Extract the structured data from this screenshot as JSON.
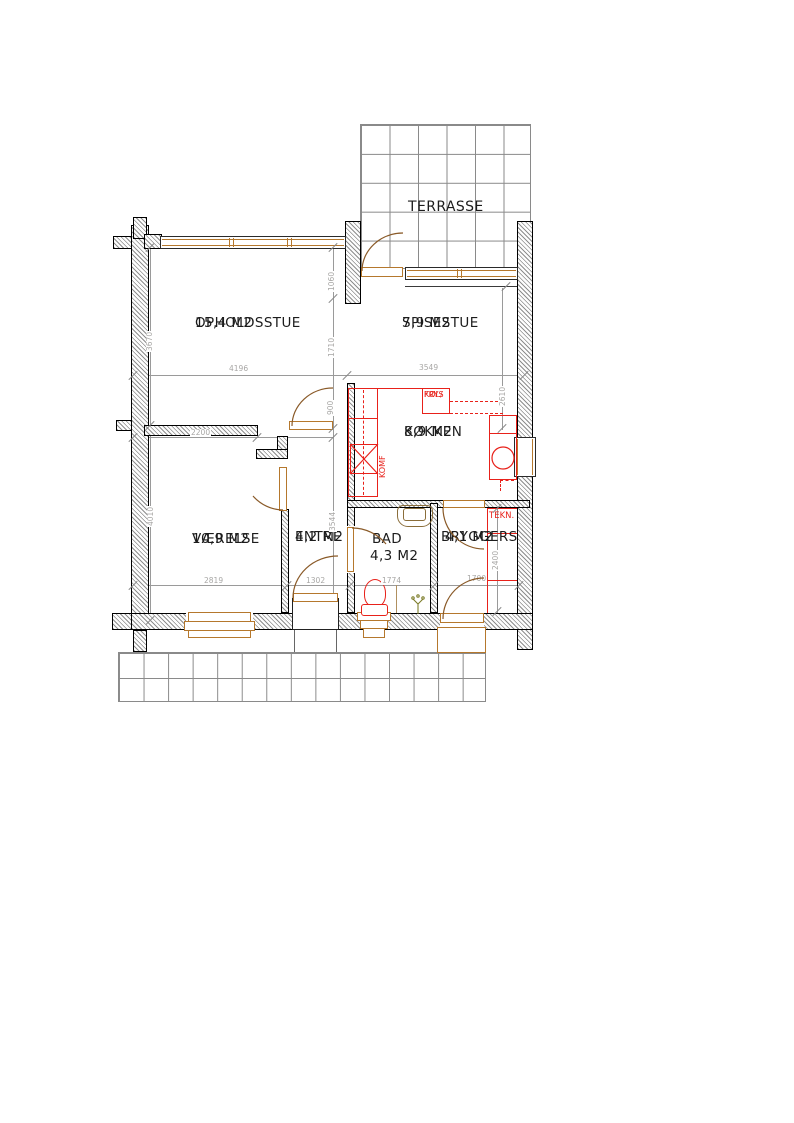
{
  "terrace": {
    "label": "TERRASSE"
  },
  "rooms": [
    {
      "name": "OPHOLDSSTUE",
      "area": "15,4 M2"
    },
    {
      "name": "SPISESTUE",
      "area": "7,9 M2"
    },
    {
      "name": "KØKKEN",
      "area": "8,9 M2"
    },
    {
      "name": "VÆRELSE",
      "area": "10,9 M2"
    },
    {
      "name": "ENTRE",
      "area": "4,2 M2"
    },
    {
      "name": "BAD",
      "area": "4,3 M2"
    },
    {
      "name": "BRYGGERS",
      "area": "4,1 M2"
    }
  ],
  "fixtures": {
    "fridge_line1": "KØL/",
    "fridge_line2": "FRYS",
    "stove": "KOMF",
    "tech": "TEKN."
  },
  "dimensions": {
    "opholdsstue_width": "4196",
    "spisestue_width": "3549",
    "vaerelse_top_width": "2200",
    "vaerelse_width": "2819",
    "entre_width": "1302",
    "bad_width": "1774",
    "bryggers_width": "1700",
    "opholdsstue_height": "3670",
    "vaerelse_height": "4010",
    "terrasse_recess": "1060",
    "spisestue_height": "1710",
    "kitchen_offset": "900",
    "entre_height": "3544",
    "kitchen_height": "2610",
    "bryggers_height": "2400"
  },
  "colors": {
    "wall_line": "#000000",
    "window_frame": "#b5782d",
    "door_arc": "#8a5a28",
    "fixture_red": "#e8211a",
    "dimension_gray": "#9a9a9a",
    "tile_line": "#8a8a8a",
    "label_text": "#1c1c1c"
  }
}
